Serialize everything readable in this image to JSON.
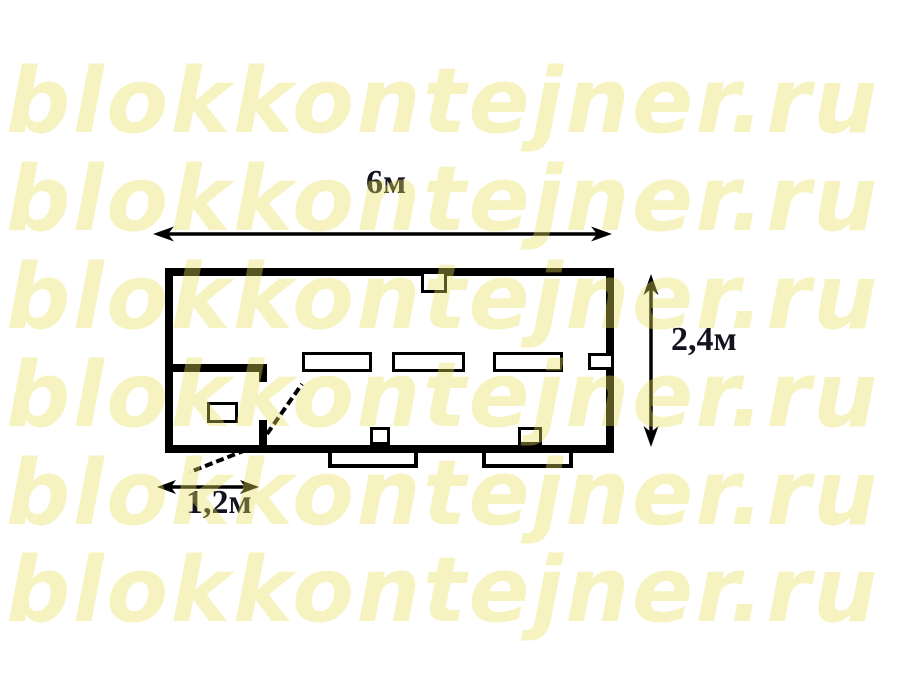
{
  "page": {
    "background": "#ffffff"
  },
  "watermark": {
    "text": "blokkontejner.ru",
    "color": "#e8e05e",
    "repeat_count": 6
  },
  "floor_plan": {
    "line_color": "#000000",
    "dimensions": {
      "width_label": "6м",
      "height_label": "2,4м",
      "entry_label": "1,2м"
    }
  }
}
